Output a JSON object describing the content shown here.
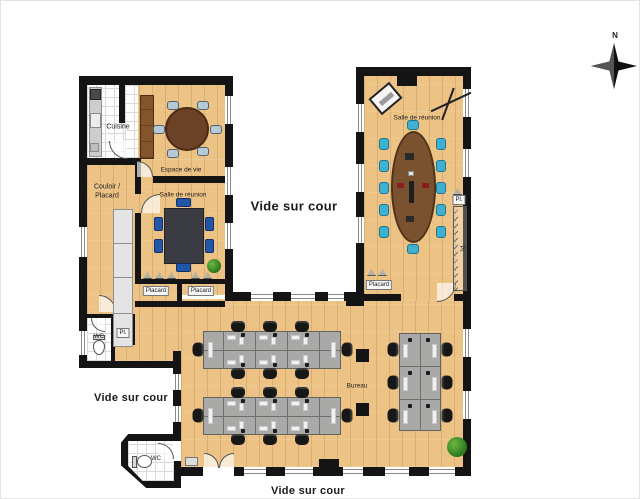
{
  "compass": {
    "north_label": "N"
  },
  "areas": {
    "vide_center": "Vide sur cour",
    "vide_left": "Vide sur cour",
    "vide_bottom": "Vide sur cour"
  },
  "rooms": {
    "cuisine": "Cuisine",
    "espace_de_vie": "Espace de vie",
    "couloir_line1": "Couloir /",
    "couloir_line2": "Placard",
    "salle_reunion_left": "Salle de réunion",
    "salle_reunion_right": "Salle de réunion",
    "bureau": "Bureau",
    "wc_left": "WC",
    "wc_bottom": "WC",
    "pl_left": "Pl.",
    "pl_right_top": "Pl.",
    "pl_right_side": "Pl.",
    "placard_left_1": "Placard",
    "placard_left_2": "Placard",
    "placard_right": "Placard"
  },
  "colors": {
    "wall": "#141414",
    "wood_floor": "#ecc285",
    "desk": "#a9a9a7",
    "chair_black": "#171717",
    "chair_cyan": "#3fb0d0",
    "chair_navy": "#2256a8",
    "table_brown": "#7a5230",
    "table_round": "#6b4226",
    "plant_green": "#2f7c1e"
  }
}
